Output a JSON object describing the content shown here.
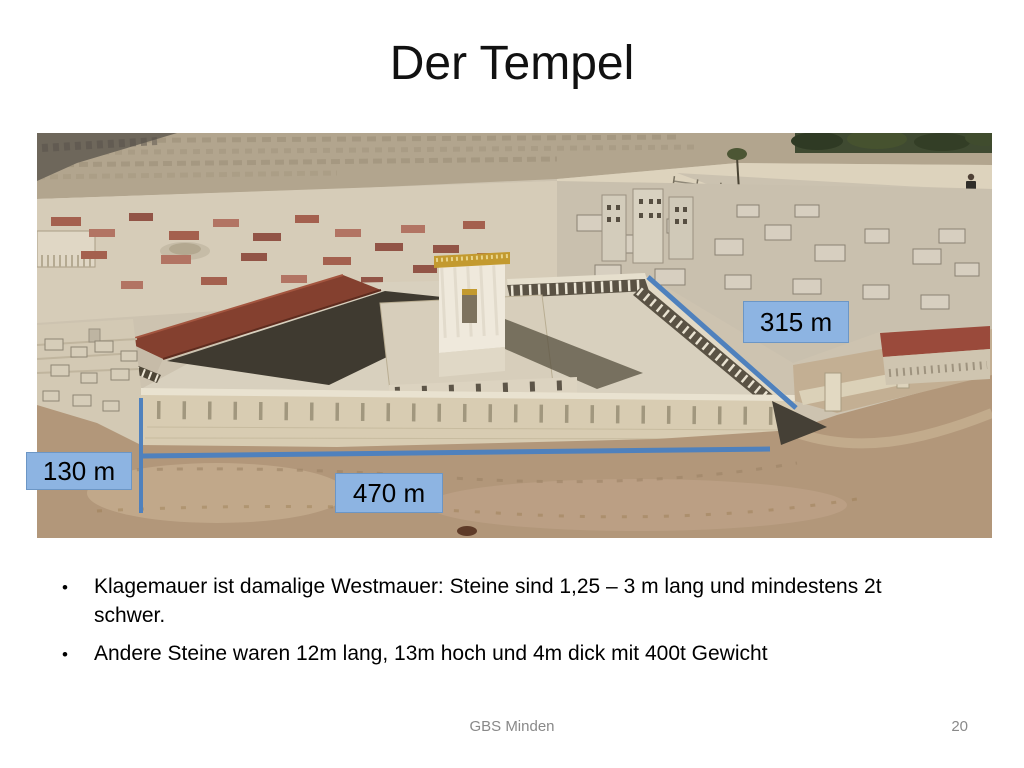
{
  "slide": {
    "title": "Der Tempel",
    "bullet_char": "•",
    "bullets": [
      "Klagemauer ist damalige Westmauer: Steine sind 1,25 – 3 m lang und mindestens 2t schwer.",
      "Andere Steine waren 12m lang, 13m hoch und 4m dick mit 400t Gewicht"
    ],
    "footer": {
      "text": "GBS Minden",
      "page_number": "20"
    }
  },
  "measurements": [
    {
      "id": "315m",
      "label": "315 m"
    },
    {
      "id": "130m",
      "label": "130 m"
    },
    {
      "id": "470m",
      "label": "470 m"
    }
  ],
  "colors": {
    "label_fill": "#8db4e2",
    "label_border": "#6c96c5",
    "measure_line": "#4f81bd",
    "footer_text": "#898989"
  }
}
